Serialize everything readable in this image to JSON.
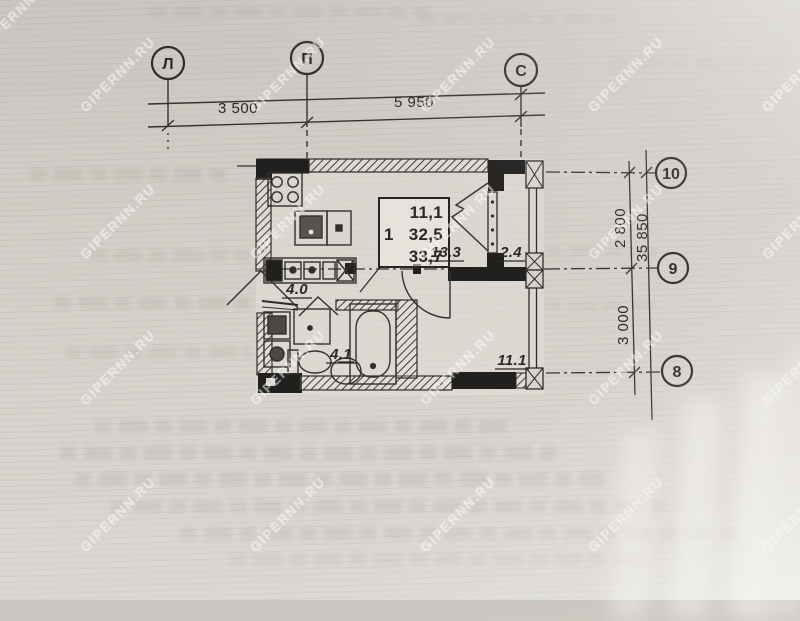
{
  "watermark": {
    "text": "GIPERNN.RU",
    "color": "#ffffff"
  },
  "axes": {
    "top": [
      {
        "label": "Л"
      },
      {
        "label": "П"
      },
      {
        "label": "С"
      }
    ],
    "right": [
      {
        "label": "10"
      },
      {
        "label": "9"
      },
      {
        "label": "8"
      }
    ]
  },
  "dimensions": {
    "top": [
      {
        "value": "3 500"
      },
      {
        "value": "5 950"
      }
    ],
    "right": [
      {
        "value": "2 800"
      },
      {
        "value": "3 000"
      }
    ],
    "right_total": "35 850"
  },
  "apartment_info_box": {
    "rooms_count": "1",
    "living_area": "11,1",
    "total_area": "32,5",
    "total_area_with_balcony": "33,7"
  },
  "room_areas": {
    "kitchen_living": "13.3",
    "balcony": "2.4",
    "hallway": "4.0",
    "bathroom": "4.1",
    "room": "11.1"
  }
}
